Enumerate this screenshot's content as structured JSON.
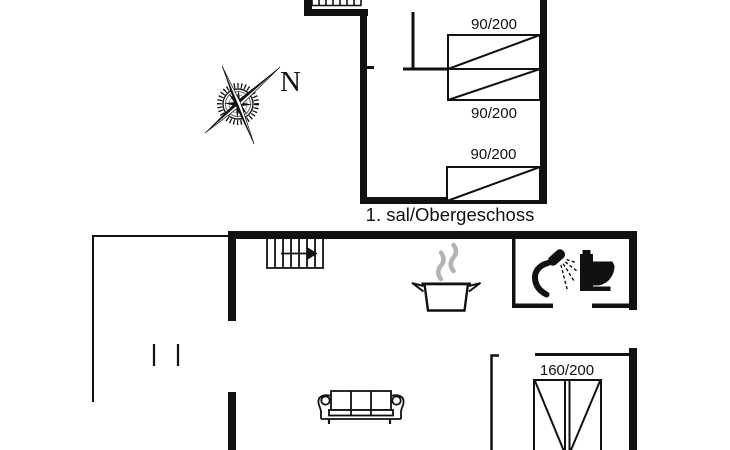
{
  "colors": {
    "line": "#111111",
    "steam": "#b3b3b3",
    "background": "#ffffff"
  },
  "compass": {
    "label": "N"
  },
  "upper_floor": {
    "caption": "1. sal/Obergeschoss",
    "door_labels": [
      "90/200",
      "90/200",
      "90/200"
    ]
  },
  "ground_floor": {
    "door_label": "160/200"
  }
}
